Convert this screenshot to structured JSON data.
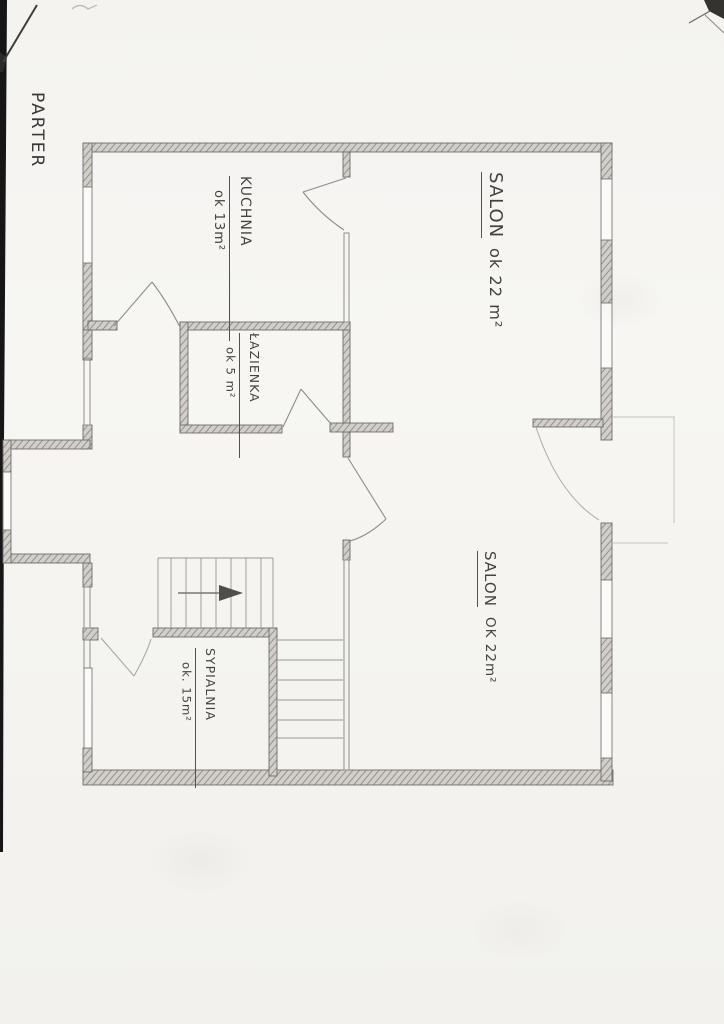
{
  "page": {
    "floor_label": "PARTER"
  },
  "rooms": [
    {
      "id": "kuchnia",
      "name": "KUCHNIA",
      "area": "ok 13m²"
    },
    {
      "id": "salon-gorny",
      "name": "SALON",
      "area": "ok 22 m²"
    },
    {
      "id": "lazienka",
      "name": "ŁAZIENKA",
      "area": "ok 5 m²"
    },
    {
      "id": "salon-dolny",
      "name": "SALON",
      "area": "OK 22m²"
    },
    {
      "id": "sypialnia",
      "name": "SYPIALNIA",
      "area": "ok. 15m²"
    }
  ],
  "colors": {
    "paper": "#f5f4f1",
    "pencil_dark": "#3f3e3c",
    "pencil_mid": "#8a8781",
    "pencil_light": "#c6c3be",
    "scan_edge": "#161616"
  }
}
